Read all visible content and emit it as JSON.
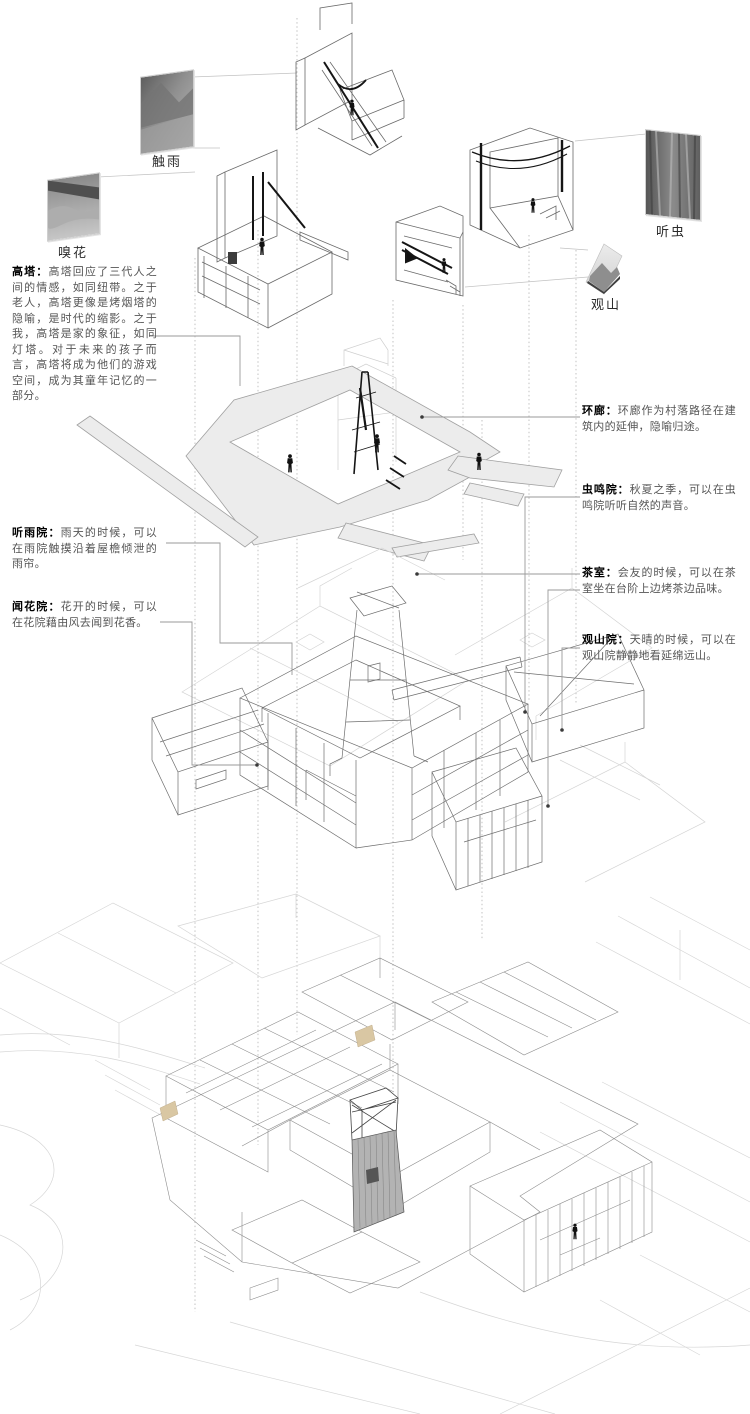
{
  "title": "exploded-axonometric-courtyard-house-diagram",
  "colors": {
    "background": "#ffffff",
    "title_text": "#000000",
    "body_text": "#555555",
    "leader_line": "#9a9a9a",
    "guide_dotted": "#b4b4b4",
    "drawing_line": "#6e6e6e",
    "ghost_line": "#d4d4d4",
    "corridor_fill": "#ececec",
    "dark_accent": "#151515",
    "tan_accent": "#d9c7a3"
  },
  "photos": [
    {
      "id": "touch-rain",
      "label": "触雨"
    },
    {
      "id": "smell-flower",
      "label": "嗅花"
    },
    {
      "id": "listen-insect",
      "label": "听虫"
    },
    {
      "id": "view-mountain",
      "label": "观山"
    }
  ],
  "annotations": {
    "left": [
      {
        "id": "tower",
        "title": "高塔：",
        "body": "高塔回应了三代人之间的情感，如同纽带。之于老人，高塔更像是烤烟塔的隐喻，是时代的缩影。之于我，高塔是家的象征，如同灯塔。对于未来的孩子而言，高塔将成为他们的游戏空间，成为其童年记忆的一部分。"
      },
      {
        "id": "rain-court",
        "title": "听雨院：",
        "body": "雨天的时候，可以在雨院触摸沿着屋檐倾泄的雨帘。"
      },
      {
        "id": "flower-court",
        "title": "闻花院：",
        "body": "花开的时候，可以在花院藉由风去闻到花香。"
      }
    ],
    "right": [
      {
        "id": "ring-corridor",
        "title": "环廊：",
        "body": "环廊作为村落路径在建筑内的延伸，隐喻归途。"
      },
      {
        "id": "insect-court",
        "title": "虫鸣院：",
        "body": "秋夏之季，可以在虫鸣院听听自然的声音。"
      },
      {
        "id": "tea-room",
        "title": "茶室：",
        "body": "会友的时候，可以在茶室坐在台阶上边烤茶边品味。"
      },
      {
        "id": "mountain-court",
        "title": "观山院：",
        "body": "天晴的时候，可以在观山院静静地看延绵远山。"
      }
    ]
  }
}
